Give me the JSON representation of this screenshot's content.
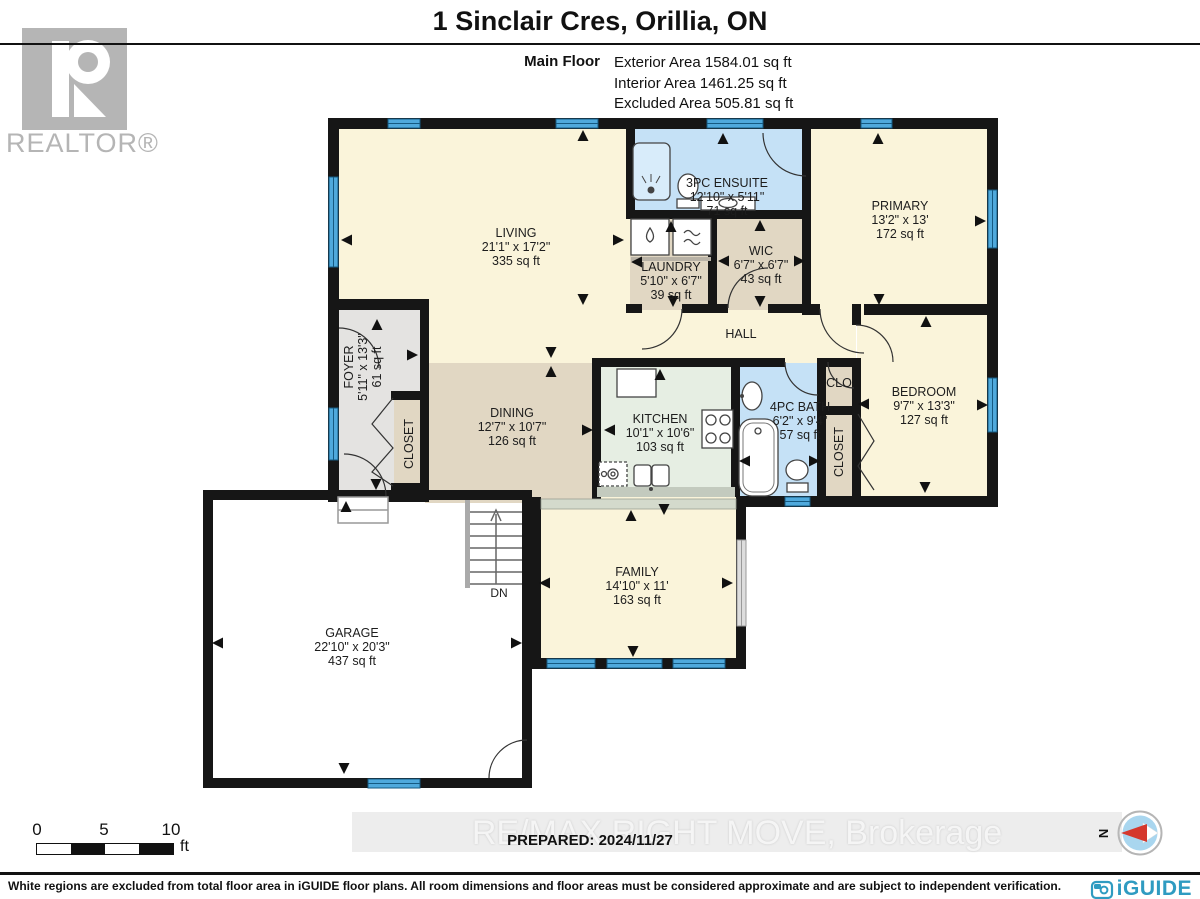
{
  "header": {
    "title": "1 Sinclair Cres, Orillia, ON",
    "floor_label": "Main Floor",
    "stats": [
      "Exterior Area 1584.01 sq ft",
      "Interior Area 1461.25 sq ft",
      "Excluded Area 505.81 sq ft"
    ]
  },
  "branding": {
    "realtor_logo_text": "REALTOR®",
    "watermark": "RE/MAX RIGHT MOVE, Brokerage",
    "prepared": "PREPARED: 2024/11/27",
    "iguide_logo_text": "iGUIDE",
    "compass_label": "N"
  },
  "rooms": [
    {
      "name": "LIVING",
      "dims": "21'1\" x 17'2\"",
      "area": "335 sq ft"
    },
    {
      "name": "3PC ENSUITE",
      "dims": "12'10\" x 5'11\"",
      "area": "71 sq ft"
    },
    {
      "name": "PRIMARY",
      "dims": "13'2\" x 13'",
      "area": "172 sq ft"
    },
    {
      "name": "LAUNDRY",
      "dims": "5'10\" x 6'7\"",
      "area": "39 sq ft"
    },
    {
      "name": "WIC",
      "dims": "6'7\" x 6'7\"",
      "area": "43 sq ft"
    },
    {
      "name": "HALL"
    },
    {
      "name": "FOYER",
      "dims": "5'11\" x 13'3\"",
      "area": "61 sq ft"
    },
    {
      "name": "CLOSET"
    },
    {
      "name": "DINING",
      "dims": "12'7\" x 10'7\"",
      "area": "126 sq ft"
    },
    {
      "name": "KITCHEN",
      "dims": "10'1\" x 10'6\"",
      "area": "103 sq ft"
    },
    {
      "name": "4PC BATH",
      "dims": "6'2\" x 9'4\"",
      "area": "57 sq ft"
    },
    {
      "name": "CLO"
    },
    {
      "name": "CLOSET"
    },
    {
      "name": "BEDROOM",
      "dims": "9'7\" x 13'3\"",
      "area": "127 sq ft"
    },
    {
      "name": "FAMILY",
      "dims": "14'10\" x 11'",
      "area": "163 sq ft"
    },
    {
      "name": "GARAGE",
      "dims": "22'10\" x 20'3\"",
      "area": "437 sq ft"
    }
  ],
  "stairs": {
    "label": "DN"
  },
  "scale_bar": {
    "ticks": [
      "0",
      "5",
      "10"
    ],
    "unit": "ft"
  },
  "footer": {
    "disclaimer": "White regions are excluded from total floor area in iGUIDE floor plans. All room dimensions and floor areas must be considered approximate and are subject to independent verification."
  },
  "colors": {
    "wall": "#161616",
    "window_blue": "#4FA9DC",
    "room_cream": "#FAF4DA",
    "room_tan": "#E1D7C3",
    "foyer_gray": "#E4E3E1",
    "kitchen_green": "#E6EEE3",
    "bath_blue": "#C5E1F6",
    "excluded_white": "#FFFFFF",
    "compass_red": "#D5382D",
    "iguide_blue": "#2F9BC1"
  }
}
